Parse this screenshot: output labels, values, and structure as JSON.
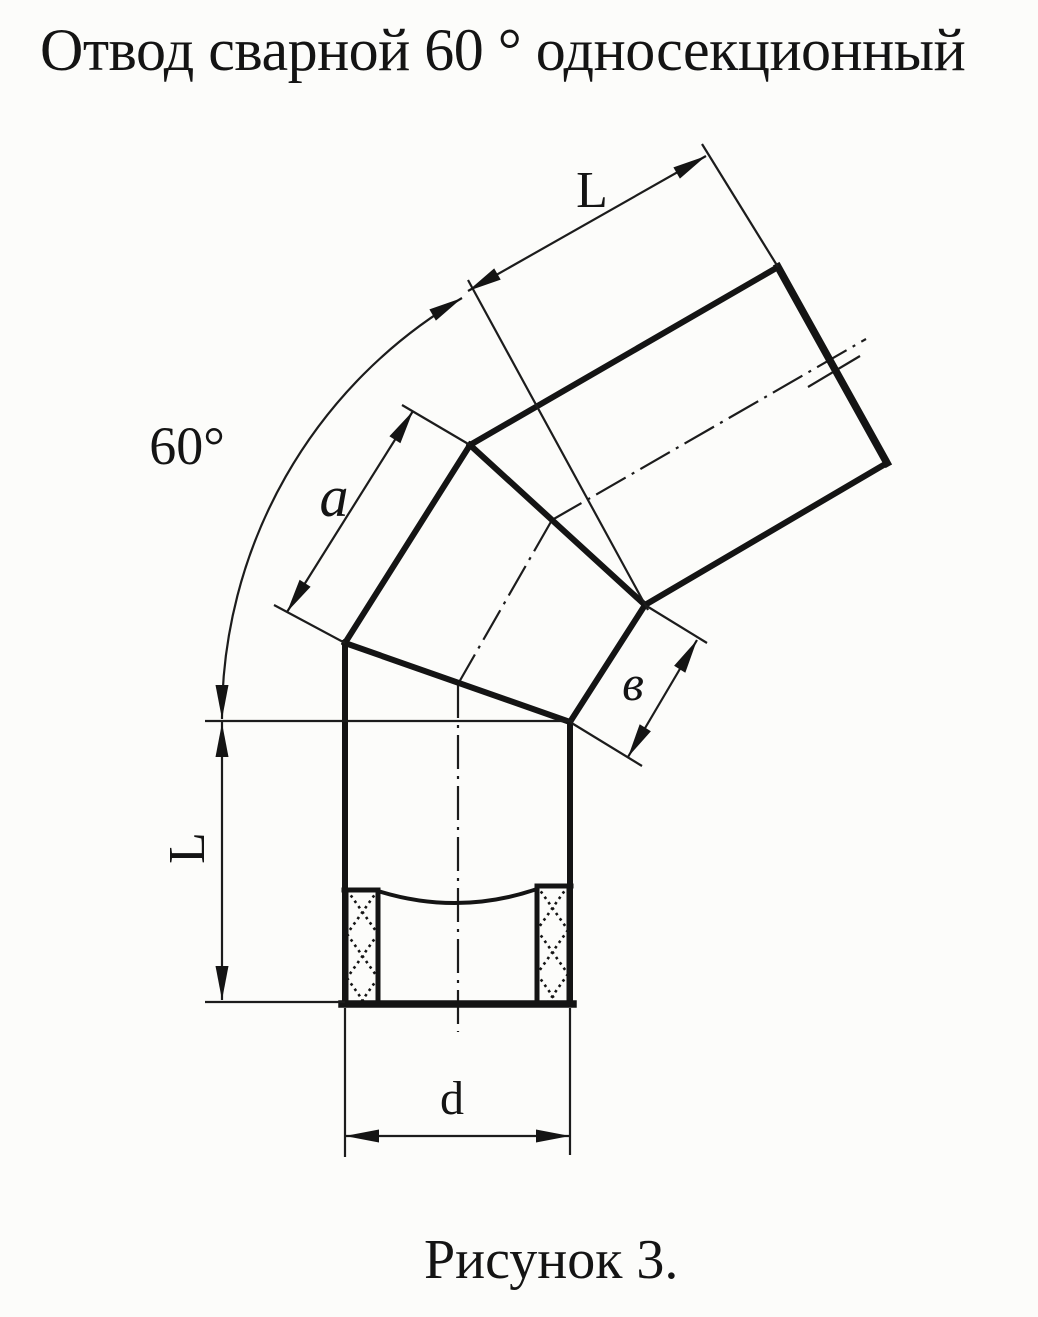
{
  "title": "Отвод сварной 60 ° односекционный",
  "caption": "Рисунок 3.",
  "labels": {
    "length_top": "L",
    "angle": "60°",
    "gore_outer_a": "a",
    "gore_inner_v": "в",
    "length_left": "L",
    "diameter_d": "d"
  },
  "drawing": {
    "subject": "welded 60 degree single-section pipe elbow",
    "segments": [
      "bottom straight pipe",
      "middle gore section",
      "upper straight pipe"
    ],
    "dimensions": [
      "L — straight pipe length (top and left)",
      "60° — bend angle",
      "a — outer gore edge",
      "в — inner gore edge",
      "d — pipe diameter"
    ]
  },
  "colors": {
    "background": "#fcfcfa",
    "line": "#141414"
  }
}
